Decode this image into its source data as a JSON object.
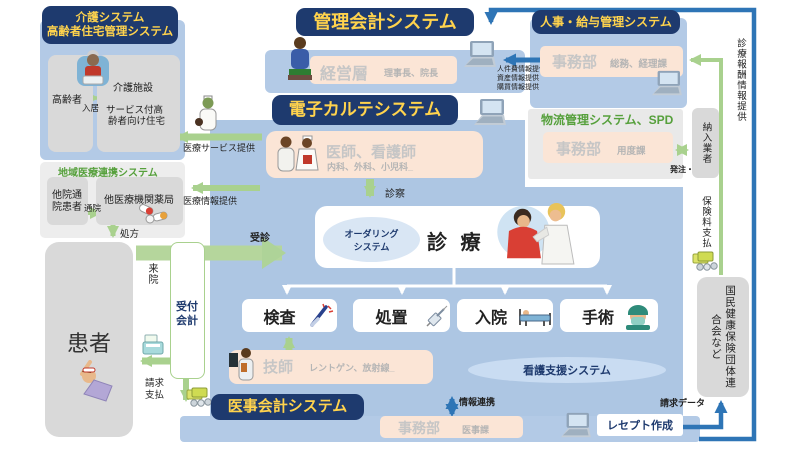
{
  "colors": {
    "header_bg": "#1e3a6e",
    "header_text": "#ffd34d",
    "panel_blue": "#b3cae6",
    "panel_blue_main": "#adc6e3",
    "cream": "#fbe5d6",
    "gray_box": "#d9d9d9",
    "arrow_green": "#a9d18e",
    "arrow_blue": "#2e75b6",
    "green_text": "#56a03c"
  },
  "care": {
    "title_line1": "介護システム",
    "title_line2": "高齢者住宅管理システム",
    "elderly": "高齢者",
    "move_in": "入居",
    "facility": "介護施設",
    "housing_line1": "サービス付高",
    "housing_line2": "齢者向け住宅",
    "service_label": "医療サービス提供"
  },
  "regional": {
    "title": "地域医療連携システム",
    "other_patient_line1": "他院通",
    "other_patient_line2": "院患者",
    "visit": "通院",
    "pharmacy": "他医療機関薬局",
    "info_label": "医療情報提供",
    "prescription": "処方"
  },
  "patient": {
    "label": "患者",
    "visit": "来院",
    "billing_line1": "請求",
    "billing_line2": "支払"
  },
  "reception": {
    "line1": "受付",
    "line2": "会計"
  },
  "mgmt": {
    "title": "管理会計システム",
    "exec": "経営層",
    "exec_sub": "理事長、院長",
    "info_lines": [
      "人件費情報提供",
      "資産情報提供",
      "購買情報提供"
    ]
  },
  "hr": {
    "title": "人事・給与管理システム",
    "dept": "事務部",
    "dept_sub": "総務、経理課"
  },
  "emr": {
    "title": "電子カルテシステム",
    "staff": "医師、看護師",
    "staff_sub": "内科、外科、小児科_",
    "exam": "診察",
    "visit": "受診",
    "ordering_line1": "オーダリング",
    "ordering_line2": "システム",
    "clinic": "診 療"
  },
  "procedures": [
    "検査",
    "処置",
    "入院",
    "手術"
  ],
  "tech": {
    "label": "技師",
    "sub": "レントゲン、放射線_"
  },
  "nursing_system": "看護支援システム",
  "logistics": {
    "title": "物流管理システム、SPD",
    "dept": "事務部",
    "dept_sub": "用度課",
    "order_label": "発注・納品",
    "supplier": "納入業者"
  },
  "medical_billing": {
    "title": "医事会計システム",
    "dept": "事務部",
    "dept_sub": "医事課",
    "link_label": "情報連携",
    "receipt": "レセプト作成",
    "claim_label": "請求データ"
  },
  "insurer": {
    "fee_info": "診療報酬情報提供",
    "premium": "保険料支払",
    "name": "国民健康保険団体連合会など"
  },
  "icons": [
    "laptop-icon",
    "money-icon",
    "elderly-person-icon",
    "nurse-icon",
    "pills-icon",
    "cash-register-icon",
    "patient-in-bed-icon",
    "executive-icon",
    "doctor-nurse-icon",
    "examination-illustration",
    "technician-icon",
    "thermometer-icon",
    "syringe-icon",
    "hospital-bed-icon",
    "surgeon-icon"
  ]
}
